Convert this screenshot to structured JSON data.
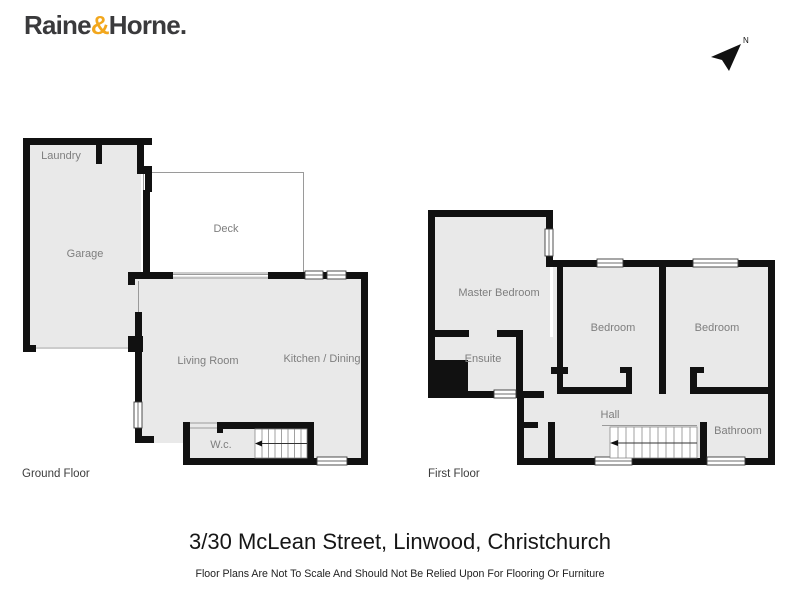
{
  "logo": {
    "raine": "Raine",
    "amp": "&",
    "horne": "Horne",
    "dot": "."
  },
  "north_indicator": {
    "label": "N"
  },
  "ground_floor": {
    "caption": "Ground Floor",
    "rooms": {
      "laundry": "Laundry",
      "garage": "Garage",
      "deck": "Deck",
      "living": "Living Room",
      "kitchen": "Kitchen / Dining",
      "wc": "W.c."
    }
  },
  "first_floor": {
    "caption": "First Floor",
    "rooms": {
      "master": "Master Bedroom",
      "ensuite": "Ensuite",
      "bedroom1": "Bedroom",
      "bedroom2": "Bedroom",
      "hall": "Hall",
      "bathroom": "Bathroom"
    }
  },
  "footer": {
    "address": "3/30 McLean Street, Linwood, Christchurch",
    "disclaimer": "Floor Plans Are Not To Scale And Should Not Be Relied Upon For Flooring Or Furniture"
  },
  "colors": {
    "brand_amber": "#F2A71D",
    "logo_text": "#3A3A3C",
    "wall": "#111111",
    "room_fill": "#E9E9E9",
    "label_gray": "#7E7E7E",
    "line_gray": "#999999"
  }
}
